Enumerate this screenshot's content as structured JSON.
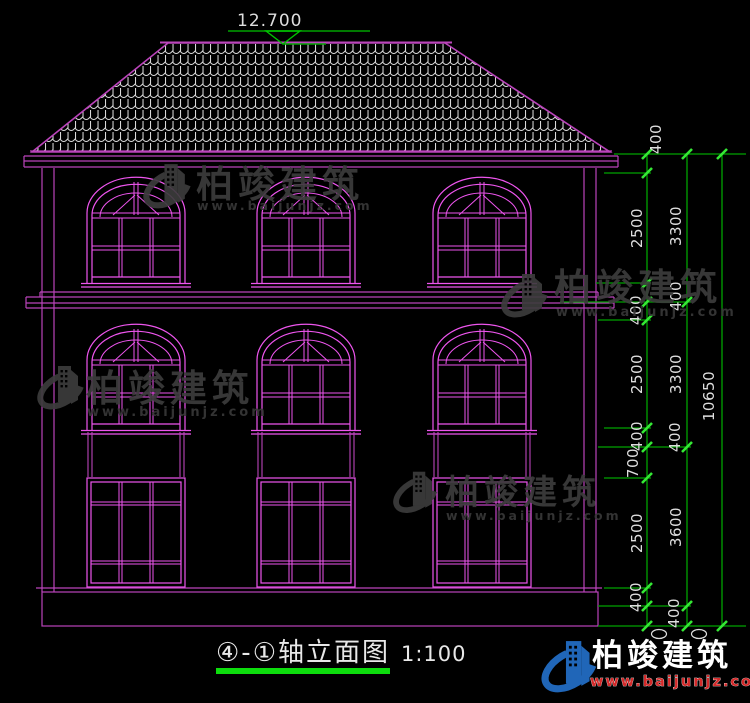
{
  "drawing": {
    "title_axis": "④-①轴立面图",
    "scale": "1:100",
    "roof_elevation": "12.700"
  },
  "dimensions": {
    "right_labels": [
      "400",
      "2500",
      "3300",
      "400",
      "400",
      "2500",
      "3300",
      "10650",
      "400",
      "400",
      "700",
      "2500",
      "3600",
      "400",
      "400"
    ]
  },
  "watermark": {
    "brand": "柏竣建筑",
    "url": "www.baijunjz.com"
  },
  "footer_logo": {
    "brand": "柏竣建筑",
    "url": "www.baijunjz.com"
  },
  "colors": {
    "wall_line": "#bb44bb",
    "window_line": "#ee55ee",
    "dimension_line": "#00a300",
    "tick": "#35e835",
    "roof_tile": "#d8d8d8",
    "text": "#dedede",
    "logo_blue": "#2066b8",
    "logo_red": "#d42a2a"
  }
}
